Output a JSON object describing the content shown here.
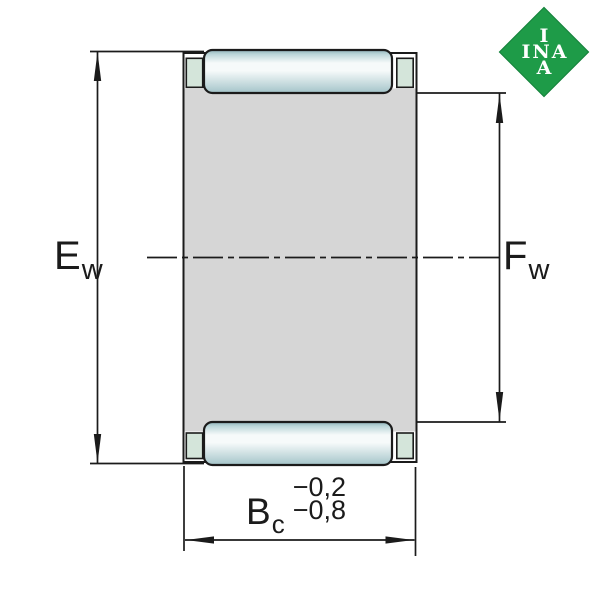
{
  "drawing": {
    "type": "technical-section-drawing",
    "subject": "needle roller and cage assembly, axial section with dimension lines",
    "labels": {
      "ew": {
        "base": "E",
        "sub": "w"
      },
      "fw": {
        "base": "F",
        "sub": "w"
      },
      "bc": {
        "base": "B",
        "sub": "c",
        "tolerance_upper": "−0,2",
        "tolerance_lower": "−0,8"
      }
    }
  },
  "logo": {
    "brand": "INA",
    "line1": "I",
    "line2": "INA",
    "line3": "A"
  },
  "colors": {
    "background": "#ffffff",
    "line": "#1b1b1b",
    "body_gray": "#d6d6d6",
    "cage_pocket_green": "#d4e5da",
    "roller_edge_dark": "#8fb3ba",
    "roller_mid": "#bcd6d9",
    "roller_light": "#f6fafa",
    "roller_bottom": "#a4c4c9",
    "logo_green": "#1e9b48",
    "logo_text": "#ffffff"
  }
}
